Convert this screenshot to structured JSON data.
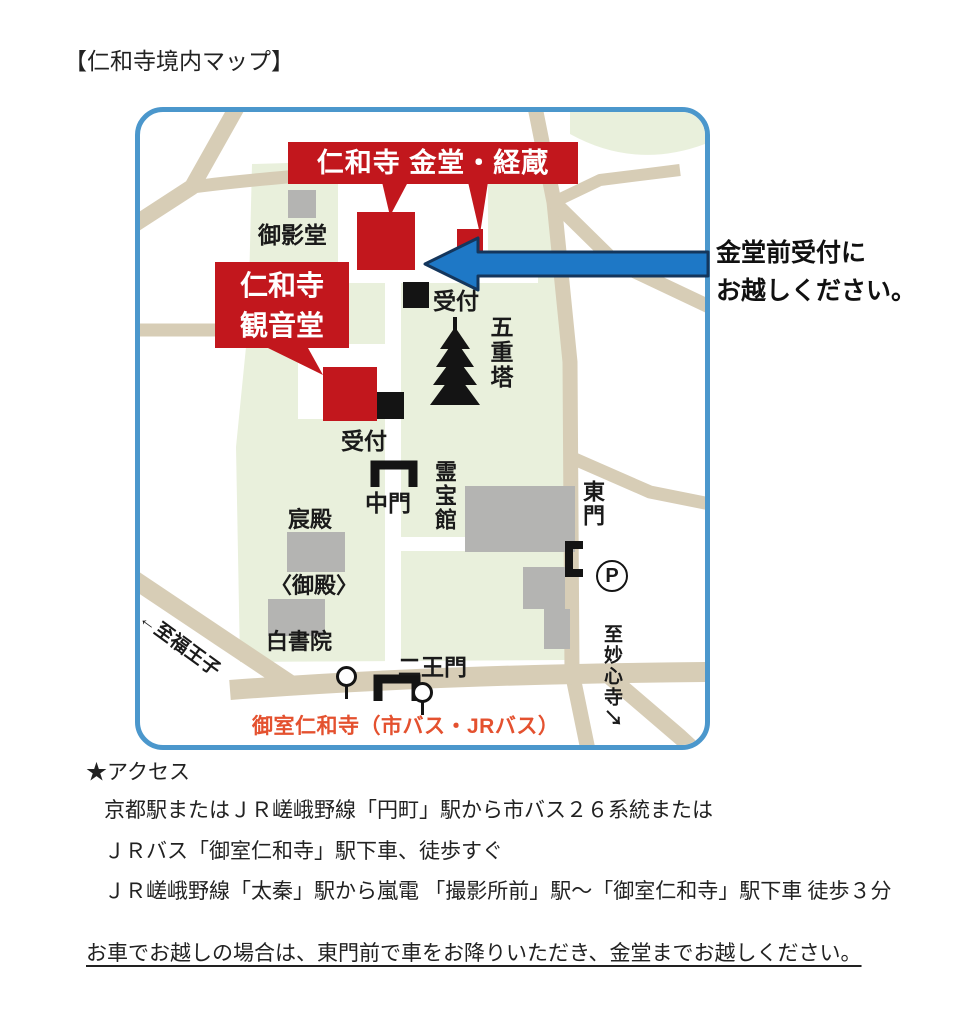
{
  "title": "【仁和寺境内マップ】",
  "annotation": {
    "line1": "金堂前受付に",
    "line2": "お越しください。"
  },
  "map": {
    "callout_kondo": "仁和寺 金堂・経蔵",
    "callout_kannondo_line1": "仁和寺",
    "callout_kannondo_line2": "観音堂",
    "labels": {
      "mieido": "御影堂",
      "reception_main": "受付",
      "reception_kannondo": "受付",
      "pagoda": "五重塔",
      "chumon": "中門",
      "reihokan": "霊宝館",
      "shinden": "宸殿",
      "goten": "〈御殿〉",
      "hakushoin": "白書院",
      "niomon": "二王門",
      "tomon": "東門",
      "parking": "P",
      "bus_stop": "御室仁和寺（市バス・JRバス）",
      "to_fukuoji": "←至福王子",
      "to_myoshinji": "至妙心寺↘"
    },
    "colors": {
      "highlight_red": "#c2171d",
      "map_border_blue": "#4b97cc",
      "arrow_blue": "#1e78c6",
      "ground_green": "#e9f0dc",
      "road_tan": "#d7cdb6",
      "building_gray": "#b4b4b2",
      "bus_text_orange": "#e4512f"
    }
  },
  "access": {
    "heading": "★アクセス",
    "lines": [
      "京都駅またはＪＲ嵯峨野線「円町」駅から市バス２６系統または",
      "ＪＲバス「御室仁和寺」駅下車、徒歩すぐ",
      "ＪＲ嵯峨野線「太秦」駅から嵐電 「撮影所前」駅～「御室仁和寺」駅下車 徒歩３分"
    ],
    "car_note": "お車でお越しの場合は、東門前で車をお降りいただき、金堂までお越しください。"
  }
}
